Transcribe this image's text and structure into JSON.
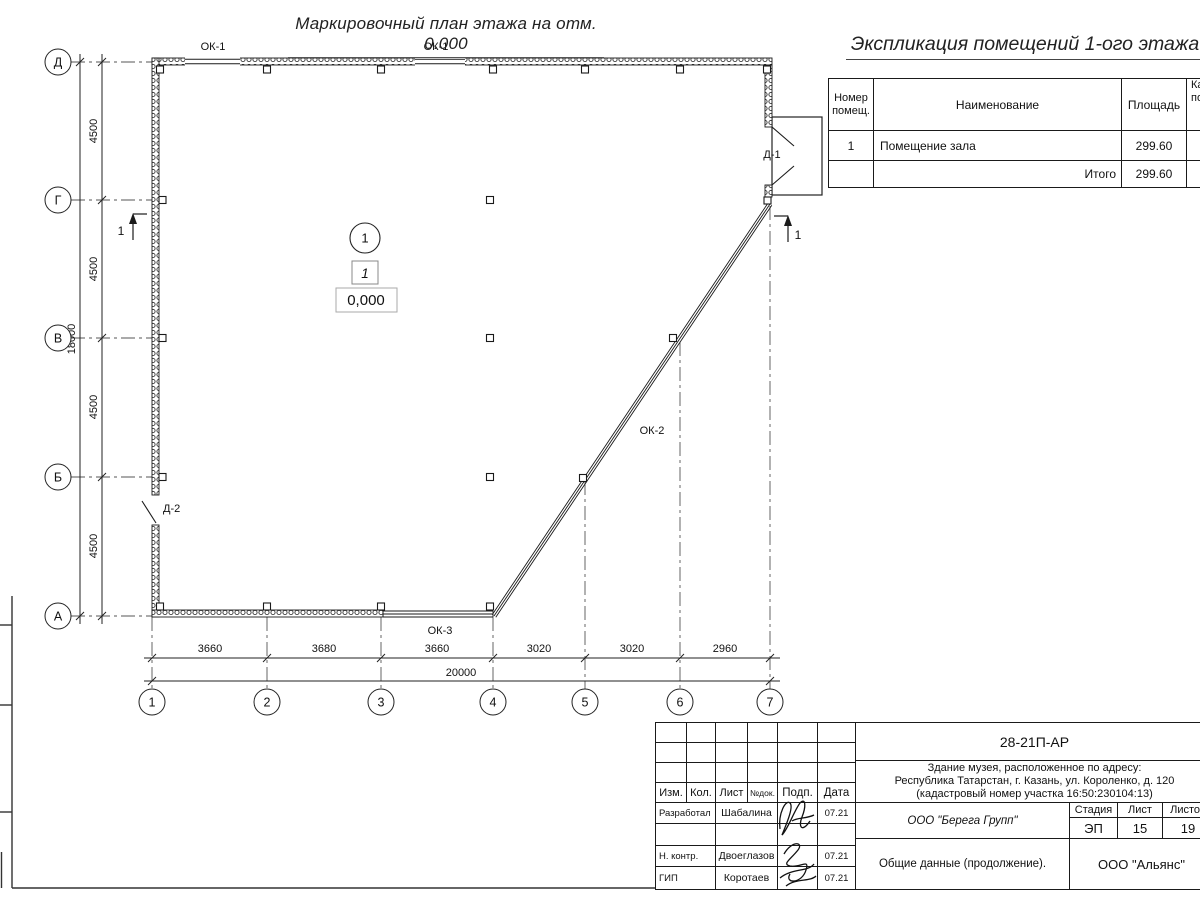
{
  "plan": {
    "title": "Маркировочный план этажа на отм. 0.000",
    "axis_rows": [
      "Д",
      "Г",
      "В",
      "Б",
      "А"
    ],
    "axis_cols": [
      "1",
      "2",
      "3",
      "4",
      "5",
      "6",
      "7"
    ],
    "dims_vertical": [
      "4500",
      "4500",
      "4500",
      "4500"
    ],
    "dim_vertical_total": "18000",
    "dims_horizontal": [
      "3660",
      "3680",
      "3660",
      "3020",
      "3020",
      "2960"
    ],
    "dim_horizontal_total": "20000",
    "window_ok1": "ОК-1",
    "window_ok2": "ОК-2",
    "window_ok3": "ОК-3",
    "door_d1": "Д-1",
    "door_d2": "Д-2",
    "room_number": "1",
    "room_mark": "1",
    "room_elevation": "0,000",
    "section_label": "1"
  },
  "expl_table": {
    "title": "Экспликация помещений 1-ого этажа",
    "col_number_l1": "Номер",
    "col_number_l2": "помещ.",
    "col_name": "Наименование",
    "col_area": "Площадь",
    "col_cat_l1": "Категория",
    "col_cat_l2": "помещения",
    "row1_number": "1",
    "row1_name": "Помещение зала",
    "row1_area": "299.60",
    "total_label": "Итого",
    "total_area": "299.60"
  },
  "titleblock": {
    "doc_number": "28-21П-АР",
    "address_line1": "Здание музея, расположенное по адресу:",
    "address_line2": "Республика Татарстан, г. Казань, ул. Короленко, д. 120",
    "address_line3": "(кадастровый номер участка 16:50:230104:13)",
    "h_izm": "Изм.",
    "h_kol": "Кол.",
    "h_list": "Лист",
    "h_doc": "№док.",
    "h_sign": "Подп.",
    "h_date": "Дата",
    "r1_role": "Разработал",
    "r1_name": "Шабалина",
    "r1_date": "07.21",
    "r2_role": "Н. контр.",
    "r2_name": "Двоеглазов",
    "r2_date": "07.21",
    "r3_role": "ГИП",
    "r3_name": "Коротаев",
    "r3_date": "07.21",
    "company": "ООО \"Берега Групп\"",
    "stage_label": "Стадия",
    "sheet_label": "Лист",
    "sheets_label": "Листов",
    "stage": "ЭП",
    "sheet": "15",
    "sheets": "19",
    "doc_title": "Общие данные (продолжение).",
    "contractor": "ООО \"Альянс\""
  }
}
